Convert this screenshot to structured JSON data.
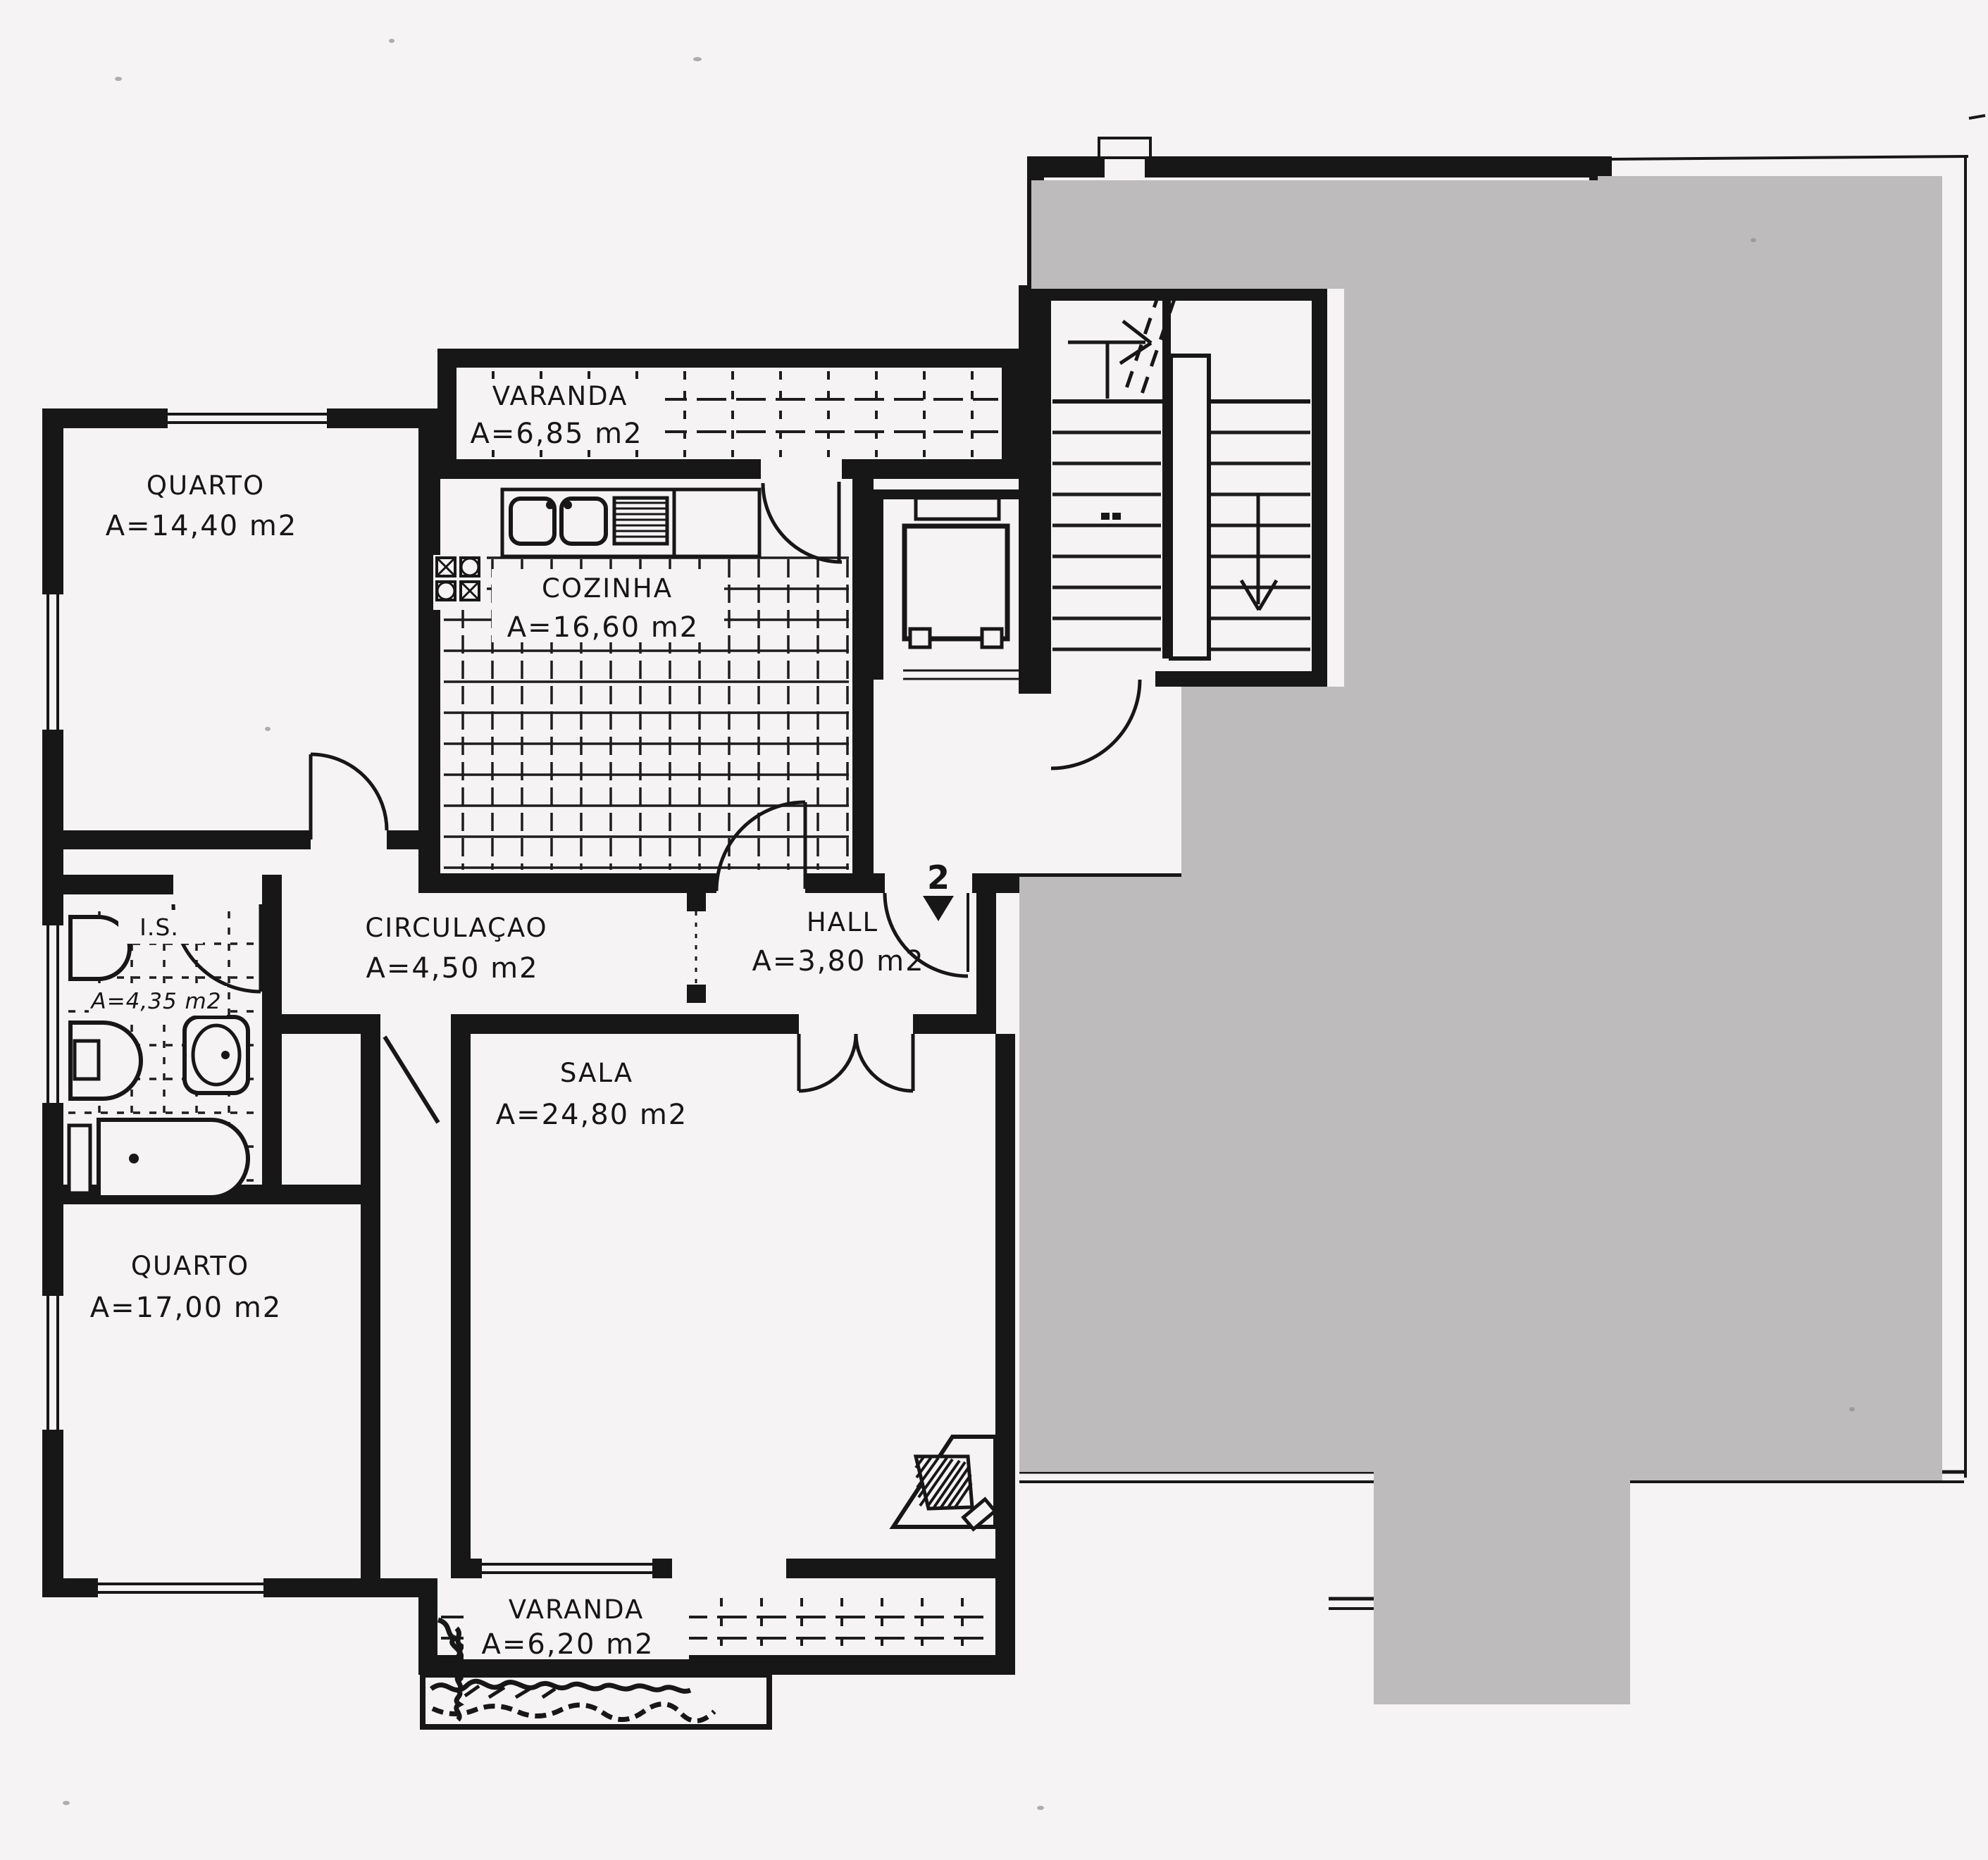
{
  "plan": {
    "title": "apartment-floor-plan-scan",
    "rooms": [
      {
        "id": "varanda_top",
        "name": "VARANDA",
        "area": "A=6,85 m2"
      },
      {
        "id": "quarto_1",
        "name": "QUARTO",
        "area": "A=14,40 m2"
      },
      {
        "id": "cozinha",
        "name": "COZINHA",
        "area": "A=16,60 m2"
      },
      {
        "id": "circulacao",
        "name": "CIRCULAÇAO",
        "area": "A=4,50 m2"
      },
      {
        "id": "hall",
        "name": "HALL",
        "area": "A=3,80 m2"
      },
      {
        "id": "is",
        "name": "I.S.",
        "area": "A=4,35 m2"
      },
      {
        "id": "sala",
        "name": "SALA",
        "area": "A=24,80 m2"
      },
      {
        "id": "quarto_2",
        "name": "QUARTO",
        "area": "A=17,00 m2"
      },
      {
        "id": "varanda_bottom",
        "name": "VARANDA",
        "area": "A=6,20 m2"
      }
    ],
    "entry_marker": "2",
    "colors": {
      "paper": "#f6f3f5",
      "ink": "#171717",
      "mask": "#bdbbbb"
    }
  }
}
